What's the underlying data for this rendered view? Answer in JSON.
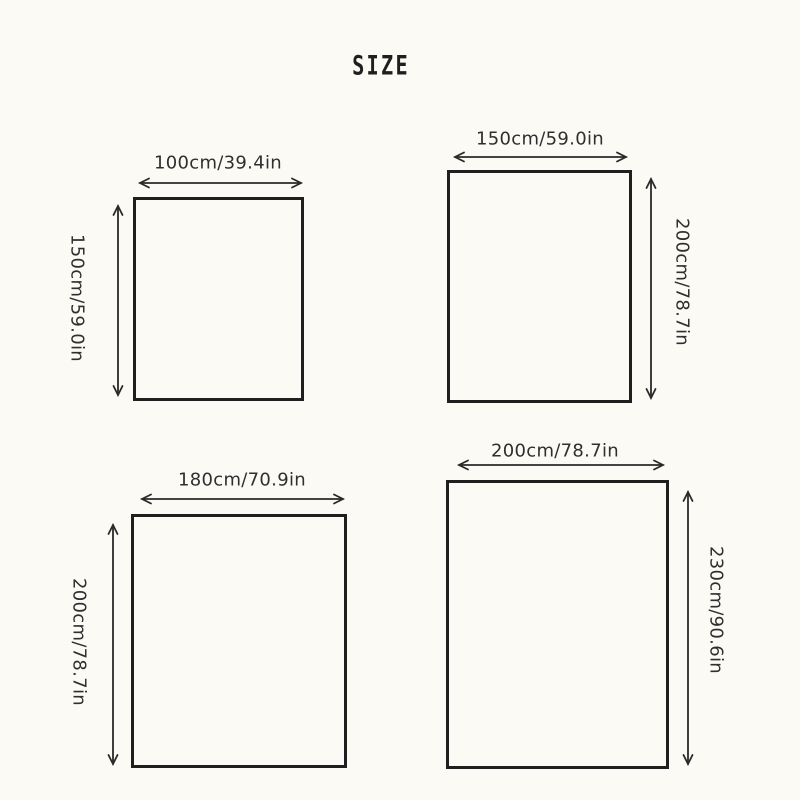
{
  "title": "SIZE",
  "colors": {
    "background": "#fcfaf5",
    "line": "#1f1f1f",
    "text": "#2f2f2f"
  },
  "sizes": [
    {
      "position": "top-left",
      "width_label": "100cm/39.4in",
      "height_label": "150cm/59.0in"
    },
    {
      "position": "top-right",
      "width_label": "150cm/59.0in",
      "height_label": "200cm/78.7in"
    },
    {
      "position": "bottom-left",
      "width_label": "180cm/70.9in",
      "height_label": "200cm/78.7in"
    },
    {
      "position": "bottom-right",
      "width_label": "200cm/78.7in",
      "height_label": "230cm/90.6in"
    }
  ]
}
